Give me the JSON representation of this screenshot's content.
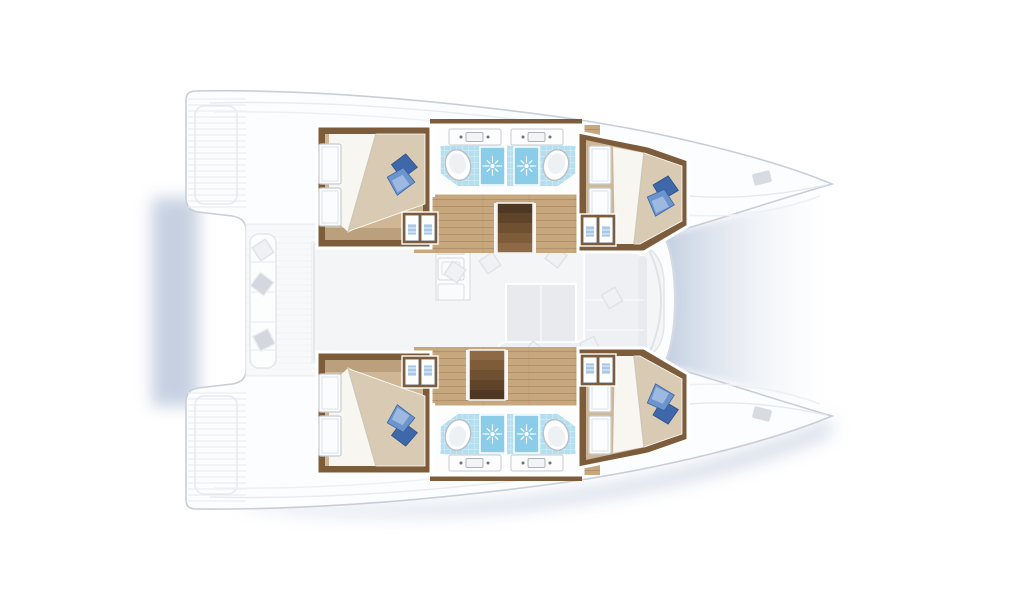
{
  "palette": {
    "hull_fill": "#fcfdfe",
    "hull_stroke": "#c7ced8",
    "shadow": "#b7c5da",
    "wood_trim": "#7d5c3c",
    "wood_floor": "#c7a87e",
    "cabin_floor": "#cfb795",
    "duvet": "#d9cbb3",
    "sheet": "#f7f6f1",
    "pillow_main": "#6d95cd",
    "pillow_dark": "#3e68aa",
    "pillow_light": "#a6c0e4",
    "bath_tile": "#b3dff0",
    "shower_tile": "#8bcce8",
    "fixture_white": "#fdfdfd",
    "ghost_fill": "#f0f1f4",
    "ghost_stroke": "#dfe2e7",
    "stair_wood_dark": "#4f3823",
    "background": "#ffffff"
  },
  "vessel": {
    "kind": "catamaran-floor-plan",
    "orientation": "bows-right",
    "summary": {
      "cabins": 4,
      "bathrooms": 4,
      "double_berths": 4,
      "toilets": 4,
      "washbasins_bath": 4,
      "showers": 4,
      "companionway_stairs": 2
    },
    "hulls": [
      {
        "name": "hull-top",
        "rooms": [
          {
            "name": "aft-cabin",
            "features": [
              "double-bed",
              "blue-pillows",
              "hull-window-panels",
              "wardrobe-locker"
            ]
          },
          {
            "name": "aft-bathroom",
            "features": [
              "washbasin",
              "toilet",
              "shower"
            ]
          },
          {
            "name": "forward-bathroom",
            "features": [
              "washbasin",
              "toilet",
              "shower"
            ]
          },
          {
            "name": "forward-cabin",
            "features": [
              "double-bed",
              "blue-pillows",
              "door-panels",
              "wardrobe-locker"
            ]
          },
          {
            "name": "companionway-stairs",
            "steps": 5
          }
        ]
      },
      {
        "name": "hull-bottom",
        "rooms": [
          {
            "name": "aft-cabin",
            "features": [
              "double-bed",
              "blue-pillows",
              "hull-window-panels",
              "wardrobe-locker"
            ]
          },
          {
            "name": "aft-bathroom",
            "features": [
              "washbasin",
              "toilet",
              "shower"
            ]
          },
          {
            "name": "forward-bathroom",
            "features": [
              "washbasin",
              "toilet",
              "shower"
            ]
          },
          {
            "name": "forward-cabin",
            "features": [
              "double-bed",
              "blue-pillows",
              "door-panels",
              "wardrobe-locker"
            ]
          },
          {
            "name": "companionway-stairs",
            "steps": 5
          }
        ]
      }
    ],
    "bridgedeck": {
      "rooms": [
        {
          "name": "saloon",
          "features": [
            "dining-table",
            "l-settee",
            "scatter-cushions"
          ],
          "style": "ghosted"
        },
        {
          "name": "galley",
          "features": [
            "four-burner-stove",
            "double-sink",
            "oven",
            "refrigerator-counter"
          ],
          "style": "ghosted"
        },
        {
          "name": "aft-cockpit",
          "features": [
            "bench-seat",
            "cushions",
            "swim-platforms"
          ],
          "style": "ghosted"
        },
        {
          "name": "foredeck",
          "features": [
            "trampoline-water-shadow",
            "deck-hatches"
          ]
        }
      ]
    }
  }
}
